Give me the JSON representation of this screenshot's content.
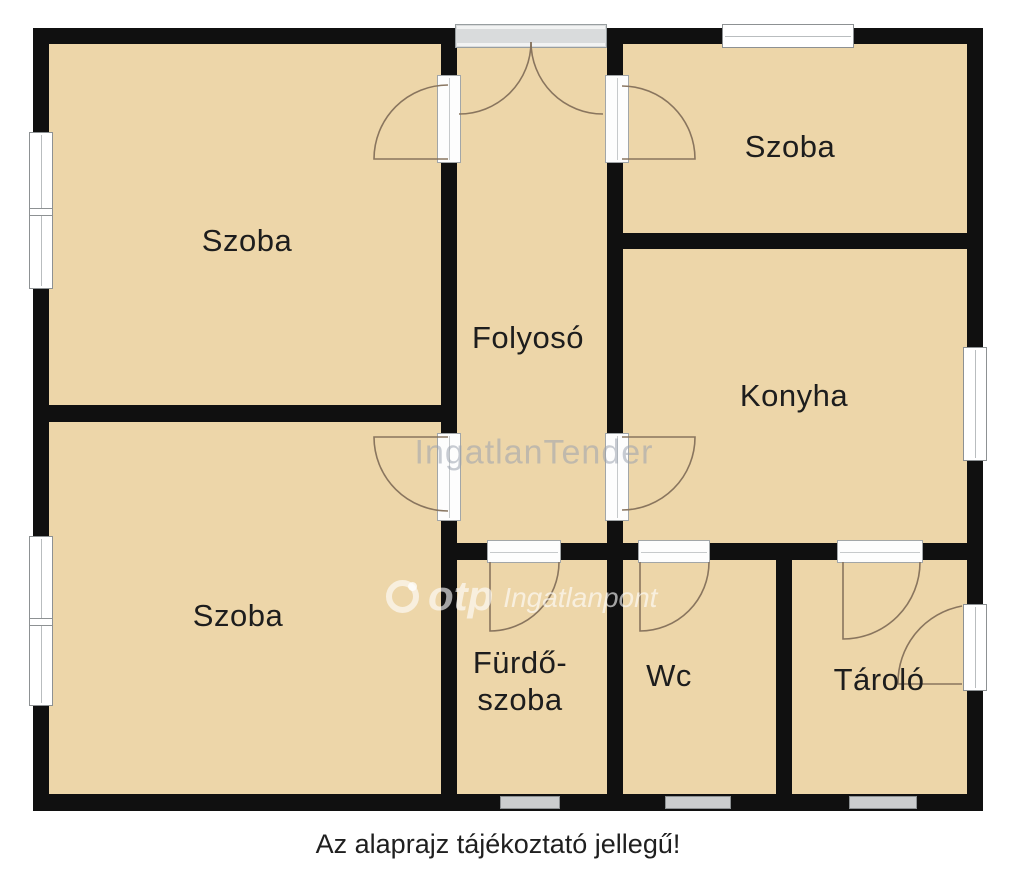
{
  "rooms": {
    "szoba_tl": {
      "label": "Szoba"
    },
    "szoba_tr": {
      "label": "Szoba"
    },
    "szoba_bl": {
      "label": "Szoba"
    },
    "folyoso": {
      "label": "Folyosó"
    },
    "konyha": {
      "label": "Konyha"
    },
    "furdoszoba": {
      "line1": "Fürdő-",
      "line2": "szoba"
    },
    "wc": {
      "label": "Wc"
    },
    "tarolo": {
      "label": "Tároló"
    }
  },
  "caption": "Az alaprajz tájékoztató jellegű!",
  "watermarks": {
    "center": "IngatlanTender",
    "brand": "otp",
    "brand_suffix": "Ingatlanpont"
  },
  "colors": {
    "background": "#ffffff",
    "floor": "#edd6a9",
    "wall": "#101010",
    "door_arc": "#84705a",
    "window_frame": "#8d9193",
    "label_text": "#1d1d1d",
    "watermark_gray": "#9ea5af",
    "watermark_white": "#ffffff"
  }
}
